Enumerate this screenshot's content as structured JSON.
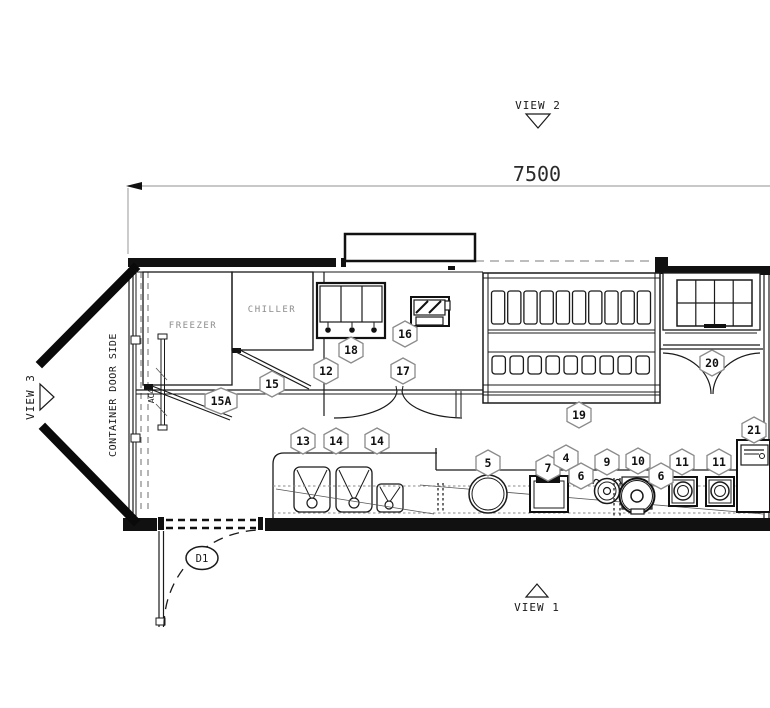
{
  "drawing": {
    "dimension_total": "7500",
    "view_1": "VIEW 1",
    "view_2": "VIEW 2",
    "view_3": "VIEW 3",
    "side_label": "CONTAINER DOOR SIDE",
    "freezer": "FREEZER",
    "chiller": "CHILLER",
    "ac_unit": "AC4",
    "door_tag": "D1"
  },
  "callouts": [
    {
      "label": "15A"
    },
    {
      "label": "15"
    },
    {
      "label": "12"
    },
    {
      "label": "18"
    },
    {
      "label": "16"
    },
    {
      "label": "17"
    },
    {
      "label": "13"
    },
    {
      "label": "14"
    },
    {
      "label": "14"
    },
    {
      "label": "5"
    },
    {
      "label": "7"
    },
    {
      "label": "4"
    },
    {
      "label": "6"
    },
    {
      "label": "9"
    },
    {
      "label": "10"
    },
    {
      "label": "6"
    },
    {
      "label": "11"
    },
    {
      "label": "11"
    },
    {
      "label": "19"
    },
    {
      "label": "20"
    },
    {
      "label": "21"
    }
  ],
  "colors": {
    "line": "#1a1a1a",
    "muted_text": "#8c8c8c",
    "dimension_line": "#b5b5b5"
  }
}
